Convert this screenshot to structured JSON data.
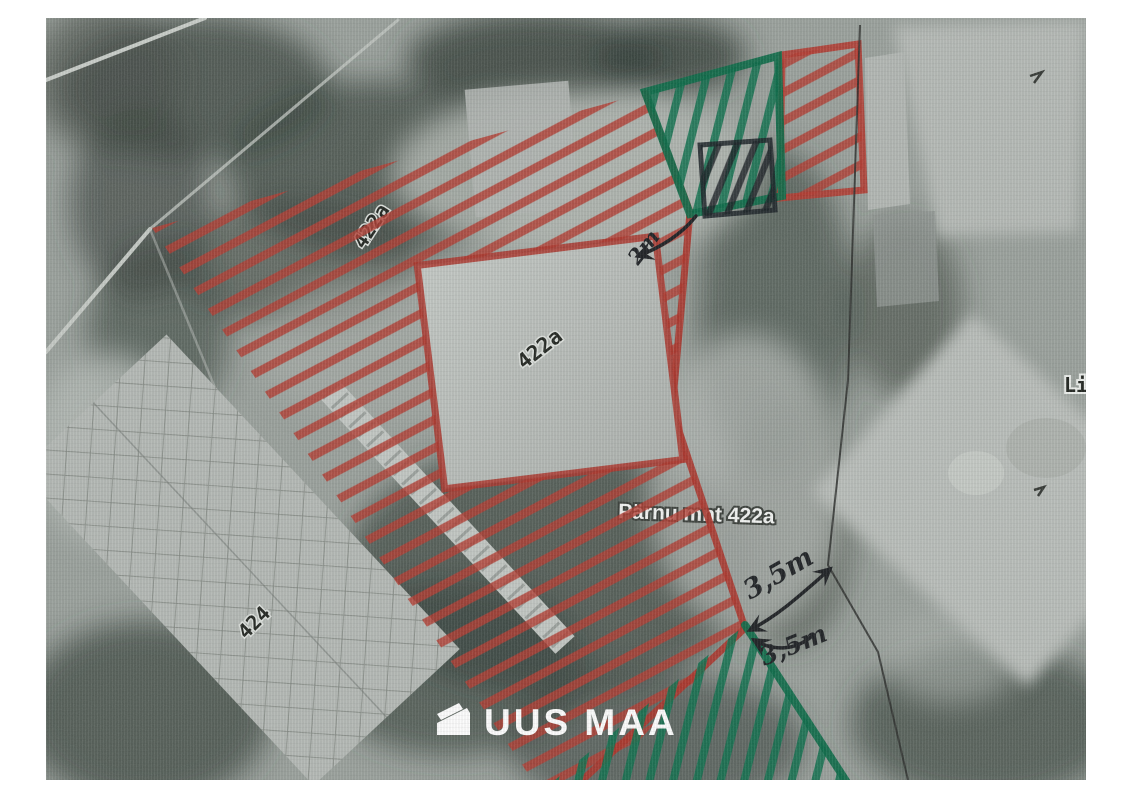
{
  "watermark": {
    "brand": "UUS MAA"
  },
  "map_labels": {
    "parcel_upper": "422a",
    "building_center": "422a",
    "building_left": "424",
    "address": "Pärnu mnt 422a",
    "street_right": "Liivik"
  },
  "annotations": {
    "measurement_top": "2m",
    "measurement_upper": "3,5m",
    "measurement_lower": "3,5m"
  },
  "colors": {
    "red_marker": "#b23a30",
    "green_marker": "#0e7350",
    "black_ink": "#1c1f22",
    "photo_base": "#9aa19c",
    "paper_white": "#ffffff"
  }
}
